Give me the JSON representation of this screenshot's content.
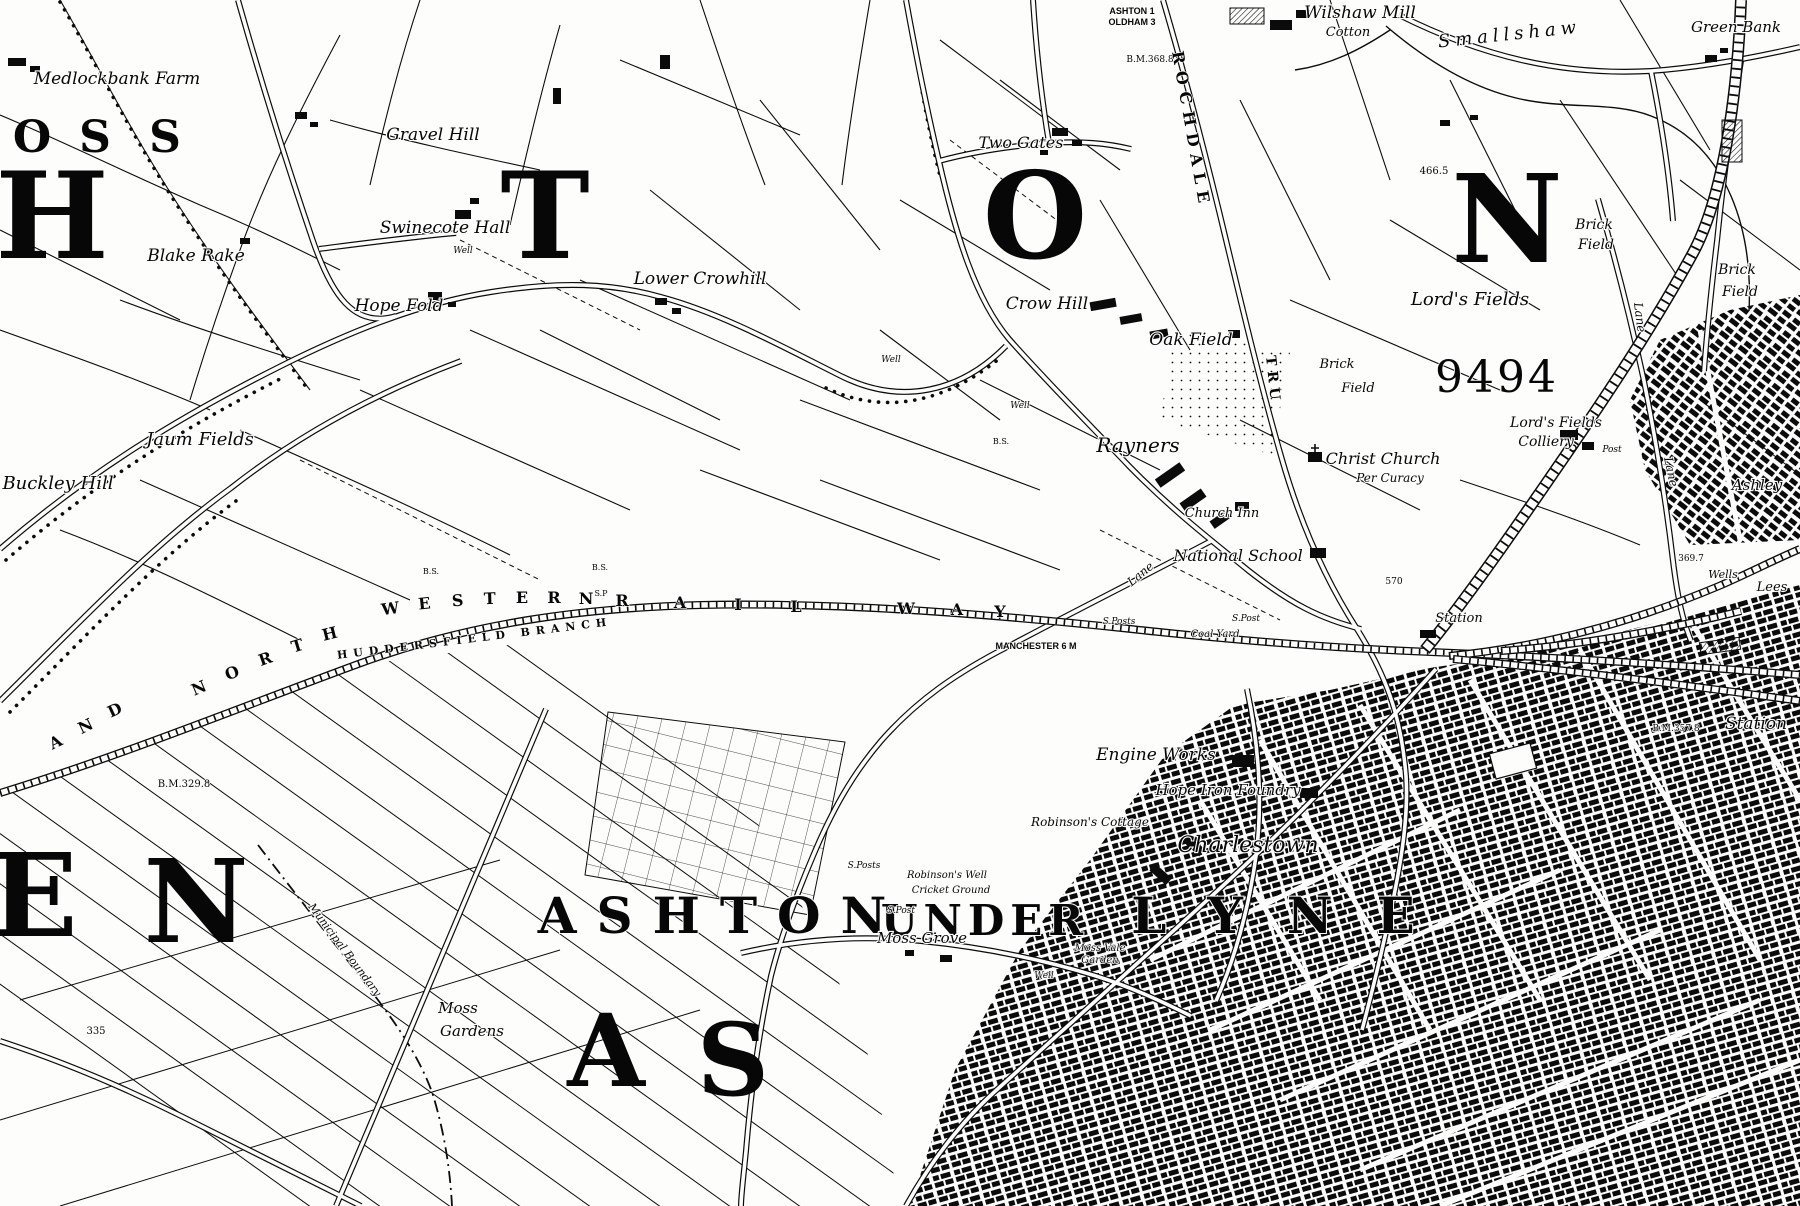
{
  "map": {
    "description": "Historic black-and-white Ordnance Survey style town map, Ashton-under-Lyne area",
    "ink_color": "#0b0b0b",
    "paper_color": "#fdfdfc",
    "labels": [
      {
        "t": "O",
        "x": 32,
        "y": 152,
        "s": 44,
        "k": "big"
      },
      {
        "t": "S",
        "x": 95,
        "y": 152,
        "s": 44,
        "k": "big"
      },
      {
        "t": "S",
        "x": 165,
        "y": 152,
        "s": 44,
        "k": "big"
      },
      {
        "t": "H",
        "x": 52,
        "y": 258,
        "s": 120,
        "k": "big"
      },
      {
        "t": "T",
        "x": 545,
        "y": 258,
        "s": 120,
        "k": "big"
      },
      {
        "t": "O",
        "x": 1035,
        "y": 258,
        "s": 120,
        "k": "big"
      },
      {
        "t": "N",
        "x": 1507,
        "y": 262,
        "s": 122,
        "k": "big"
      },
      {
        "t": "E",
        "x": 34,
        "y": 936,
        "s": 115,
        "k": "big"
      },
      {
        "t": "N",
        "x": 196,
        "y": 942,
        "s": 115,
        "k": "big"
      },
      {
        "t": "A",
        "x": 606,
        "y": 1086,
        "s": 100,
        "k": "big"
      },
      {
        "t": "S",
        "x": 733,
        "y": 1095,
        "s": 100,
        "k": "big"
      },
      {
        "t": "ASHTON",
        "x": 722,
        "y": 933,
        "s": 50,
        "k": "town",
        "ls": 20
      },
      {
        "t": "UNDER",
        "x": 985,
        "y": 935,
        "s": 42,
        "k": "town",
        "ls": 6
      },
      {
        "t": "LYNE",
        "x": 1295,
        "y": 933,
        "s": 50,
        "k": "town",
        "ls": 44
      },
      {
        "t": "Medlockbank Farm",
        "x": 117,
        "y": 84,
        "s": 17,
        "k": "place"
      },
      {
        "t": "Gravel Hill",
        "x": 433,
        "y": 140,
        "s": 17,
        "k": "place"
      },
      {
        "t": "Swinecote Hall",
        "x": 445,
        "y": 233,
        "s": 17,
        "k": "place"
      },
      {
        "t": "Well",
        "x": 463,
        "y": 253,
        "s": 9,
        "k": "tiny"
      },
      {
        "t": "Blake Rake",
        "x": 196,
        "y": 261,
        "s": 17,
        "k": "place"
      },
      {
        "t": "Hope Fold",
        "x": 399,
        "y": 311,
        "s": 17,
        "k": "place"
      },
      {
        "t": "Lower Crowhill",
        "x": 700,
        "y": 284,
        "s": 17,
        "k": "place"
      },
      {
        "t": "Two Gates",
        "x": 1021,
        "y": 148,
        "s": 16,
        "k": "place"
      },
      {
        "t": "Wilshaw Mill",
        "x": 1360,
        "y": 18,
        "s": 17,
        "k": "place"
      },
      {
        "t": "Cotton",
        "x": 1348,
        "y": 36,
        "s": 13,
        "k": "place"
      },
      {
        "t": "Smallshaw",
        "x": 1510,
        "y": 40,
        "s": 18,
        "k": "place",
        "r": -6,
        "ls": 5
      },
      {
        "t": "Green Bank",
        "x": 1736,
        "y": 32,
        "s": 15,
        "k": "place"
      },
      {
        "t": "Brick",
        "x": 1594,
        "y": 229,
        "s": 14,
        "k": "place"
      },
      {
        "t": "Field",
        "x": 1596,
        "y": 249,
        "s": 14,
        "k": "place"
      },
      {
        "t": "Brick",
        "x": 1737,
        "y": 274,
        "s": 14,
        "k": "place"
      },
      {
        "t": "Field",
        "x": 1740,
        "y": 296,
        "s": 14,
        "k": "place"
      },
      {
        "t": "Lord's Fields",
        "x": 1470,
        "y": 305,
        "s": 18,
        "k": "place"
      },
      {
        "t": "Brick",
        "x": 1337,
        "y": 368,
        "s": 13,
        "k": "place"
      },
      {
        "t": "Field",
        "x": 1358,
        "y": 392,
        "s": 13,
        "k": "place"
      },
      {
        "t": "9494",
        "x": 1497,
        "y": 392,
        "s": 44,
        "k": "num",
        "ls": 3
      },
      {
        "t": "Crow Hill",
        "x": 1047,
        "y": 309,
        "s": 17,
        "k": "place"
      },
      {
        "t": "Oak Field",
        "x": 1191,
        "y": 345,
        "s": 17,
        "k": "place"
      },
      {
        "t": "Well",
        "x": 891,
        "y": 362,
        "s": 9,
        "k": "tiny"
      },
      {
        "t": "Well",
        "x": 1020,
        "y": 408,
        "s": 9,
        "k": "tiny"
      },
      {
        "t": "Rayners",
        "x": 1138,
        "y": 452,
        "s": 20,
        "k": "place"
      },
      {
        "t": "Christ Church",
        "x": 1383,
        "y": 464,
        "s": 16,
        "k": "place"
      },
      {
        "t": "Per Curacy",
        "x": 1390,
        "y": 482,
        "s": 12,
        "k": "place"
      },
      {
        "t": "Church Inn",
        "x": 1222,
        "y": 517,
        "s": 13,
        "k": "place"
      },
      {
        "t": "National School",
        "x": 1238,
        "y": 561,
        "s": 16,
        "k": "place"
      },
      {
        "t": "Jaum Fields",
        "x": 200,
        "y": 445,
        "s": 18,
        "k": "place"
      },
      {
        "t": "Buckley Hill",
        "x": 58,
        "y": 489,
        "s": 18,
        "k": "place"
      },
      {
        "t": "Lord's Fields",
        "x": 1556,
        "y": 427,
        "s": 14,
        "k": "place"
      },
      {
        "t": "Colliery",
        "x": 1546,
        "y": 446,
        "s": 14,
        "k": "place"
      },
      {
        "t": "Post",
        "x": 1612,
        "y": 452,
        "s": 9,
        "k": "tiny"
      },
      {
        "t": "Ashley",
        "x": 1757,
        "y": 490,
        "s": 15,
        "k": "place"
      },
      {
        "t": "Wells",
        "x": 1723,
        "y": 578,
        "s": 11,
        "k": "place"
      },
      {
        "t": "Lees",
        "x": 1772,
        "y": 591,
        "s": 13,
        "k": "place"
      },
      {
        "t": "Station",
        "x": 1459,
        "y": 622,
        "s": 13,
        "k": "place"
      },
      {
        "t": "Station",
        "x": 1756,
        "y": 729,
        "s": 17,
        "k": "place"
      },
      {
        "t": "Coal Yard",
        "x": 1215,
        "y": 637,
        "s": 10,
        "k": "tiny"
      },
      {
        "t": "Engine Works",
        "x": 1156,
        "y": 760,
        "s": 17,
        "k": "place"
      },
      {
        "t": "Hope Iron Foundry",
        "x": 1228,
        "y": 795,
        "s": 15,
        "k": "place"
      },
      {
        "t": "Robinson's Cottage",
        "x": 1090,
        "y": 826,
        "s": 12,
        "k": "place"
      },
      {
        "t": "Robinson's Well",
        "x": 947,
        "y": 878,
        "s": 10,
        "k": "tiny"
      },
      {
        "t": "Cricket Ground",
        "x": 951,
        "y": 893,
        "s": 10,
        "k": "tiny"
      },
      {
        "t": "Charlestown",
        "x": 1248,
        "y": 852,
        "s": 22,
        "k": "place"
      },
      {
        "t": "Moss Grove",
        "x": 922,
        "y": 943,
        "s": 15,
        "k": "place"
      },
      {
        "t": "Moss Vale",
        "x": 1100,
        "y": 951,
        "s": 10,
        "k": "tiny"
      },
      {
        "t": "Garden",
        "x": 1100,
        "y": 963,
        "s": 10,
        "k": "tiny"
      },
      {
        "t": "Well",
        "x": 1044,
        "y": 978,
        "s": 9,
        "k": "tiny"
      },
      {
        "t": "Moss",
        "x": 458,
        "y": 1013,
        "s": 15,
        "k": "place"
      },
      {
        "t": "Gardens",
        "x": 472,
        "y": 1036,
        "s": 15,
        "k": "place"
      },
      {
        "t": "Municipal Boundary",
        "x": 342,
        "y": 952,
        "s": 11,
        "k": "place",
        "r": 53
      },
      {
        "t": "ASHTON 1",
        "x": 1132,
        "y": 14,
        "s": 9,
        "k": "caps"
      },
      {
        "t": "OLDHAM 3",
        "x": 1132,
        "y": 25,
        "s": 9,
        "k": "caps"
      },
      {
        "t": "MANCHESTER 6 M",
        "x": 1036,
        "y": 649,
        "s": 9,
        "k": "caps"
      },
      {
        "t": "B.M.329.8",
        "x": 184,
        "y": 787,
        "s": 10,
        "k": "num"
      },
      {
        "t": "B.M.368.8",
        "x": 1150,
        "y": 62,
        "s": 9,
        "k": "num"
      },
      {
        "t": "B.M.357.8",
        "x": 1676,
        "y": 731,
        "s": 9,
        "k": "num"
      },
      {
        "t": "466.5",
        "x": 1434,
        "y": 174,
        "s": 10,
        "k": "num"
      },
      {
        "t": "570",
        "x": 1394,
        "y": 584,
        "s": 9,
        "k": "num"
      },
      {
        "t": "369.7",
        "x": 1691,
        "y": 561,
        "s": 9,
        "k": "num"
      },
      {
        "t": "335",
        "x": 96,
        "y": 1034,
        "s": 10,
        "k": "num"
      },
      {
        "t": "S.P",
        "x": 601,
        "y": 596,
        "s": 8,
        "k": "num"
      },
      {
        "t": "B.S.",
        "x": 600,
        "y": 570,
        "s": 8,
        "k": "num"
      },
      {
        "t": "B.S.",
        "x": 431,
        "y": 574,
        "s": 8,
        "k": "num"
      },
      {
        "t": "B.S.",
        "x": 1001,
        "y": 444,
        "s": 8,
        "k": "num"
      },
      {
        "t": "S.Posts",
        "x": 1119,
        "y": 624,
        "s": 9,
        "k": "tiny"
      },
      {
        "t": "S.Post",
        "x": 1246,
        "y": 621,
        "s": 9,
        "k": "tiny"
      },
      {
        "t": "S.Posts",
        "x": 864,
        "y": 868,
        "s": 9,
        "k": "tiny"
      },
      {
        "t": "S.Post",
        "x": 901,
        "y": 913,
        "s": 9,
        "k": "tiny"
      },
      {
        "t": "A",
        "x": 58,
        "y": 747,
        "s": 16,
        "k": "rail",
        "r": -26
      },
      {
        "t": "N",
        "x": 88,
        "y": 731,
        "s": 16,
        "k": "rail",
        "r": -26
      },
      {
        "t": "D",
        "x": 117,
        "y": 715,
        "s": 16,
        "k": "rail",
        "r": -25
      },
      {
        "t": "N",
        "x": 201,
        "y": 693,
        "s": 16,
        "k": "rail",
        "r": -23
      },
      {
        "t": "O",
        "x": 234,
        "y": 678,
        "s": 16,
        "k": "rail",
        "r": -21
      },
      {
        "t": "R",
        "x": 267,
        "y": 664,
        "s": 16,
        "k": "rail",
        "r": -19
      },
      {
        "t": "T",
        "x": 299,
        "y": 651,
        "s": 16,
        "k": "rail",
        "r": -17
      },
      {
        "t": "H",
        "x": 331,
        "y": 639,
        "s": 16,
        "k": "rail",
        "r": -14
      },
      {
        "t": "W",
        "x": 391,
        "y": 614,
        "s": 16,
        "k": "rail",
        "r": -8
      },
      {
        "t": "E",
        "x": 425,
        "y": 609,
        "s": 16,
        "k": "rail",
        "r": -6
      },
      {
        "t": "S",
        "x": 458,
        "y": 606,
        "s": 16,
        "k": "rail",
        "r": -4
      },
      {
        "t": "T",
        "x": 490,
        "y": 604,
        "s": 16,
        "k": "rail",
        "r": -2
      },
      {
        "t": "E",
        "x": 522,
        "y": 603,
        "s": 16,
        "k": "rail"
      },
      {
        "t": "R",
        "x": 554,
        "y": 603,
        "s": 16,
        "k": "rail"
      },
      {
        "t": "N",
        "x": 586,
        "y": 604,
        "s": 16,
        "k": "rail"
      },
      {
        "t": "R",
        "x": 622,
        "y": 606,
        "s": 16,
        "k": "rail"
      },
      {
        "t": "A",
        "x": 680,
        "y": 608,
        "s": 16,
        "k": "rail"
      },
      {
        "t": "I",
        "x": 738,
        "y": 610,
        "s": 16,
        "k": "rail"
      },
      {
        "t": "L",
        "x": 796,
        "y": 612,
        "s": 16,
        "k": "rail"
      },
      {
        "t": "W",
        "x": 906,
        "y": 614,
        "s": 16,
        "k": "rail"
      },
      {
        "t": "A",
        "x": 957,
        "y": 615,
        "s": 16,
        "k": "rail"
      },
      {
        "t": "Y",
        "x": 1000,
        "y": 617,
        "s": 16,
        "k": "rail"
      },
      {
        "t": "HUDDERSFIELD BRANCH",
        "x": 475,
        "y": 642,
        "s": 11,
        "k": "rail",
        "ls": 6,
        "r": -7
      },
      {
        "t": "ROCHDALE",
        "x": 1172,
        "y": 52,
        "s": 16,
        "k": "road",
        "r": 80,
        "a": "start",
        "ls": 7
      },
      {
        "t": "TRU",
        "x": 1266,
        "y": 356,
        "s": 14,
        "k": "road",
        "r": 84,
        "a": "start",
        "ls": 5
      },
      {
        "t": "Lane",
        "x": 1634,
        "y": 303,
        "s": 12,
        "k": "place",
        "r": 83,
        "a": "start"
      },
      {
        "t": "Lane",
        "x": 1664,
        "y": 458,
        "s": 12,
        "k": "place",
        "r": 78,
        "a": "start"
      },
      {
        "t": "Lane",
        "x": 1143,
        "y": 577,
        "s": 12,
        "k": "place",
        "r": -40
      }
    ]
  }
}
